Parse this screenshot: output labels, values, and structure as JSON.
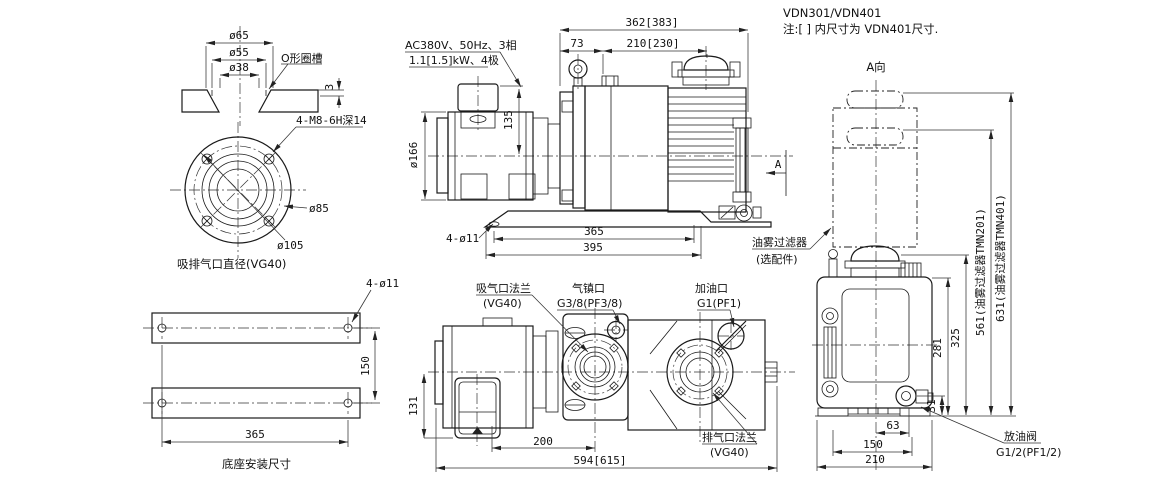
{
  "colors": {
    "line": "#1a1a1a",
    "background": "#ffffff"
  },
  "title": {
    "model": "VDN301/VDN401",
    "note": "注:[ ] 内尺寸为 VDN401尺寸."
  },
  "port_detail": {
    "d65": "ø65",
    "d55": "ø55",
    "d38": "ø38",
    "oring_label": "O形圈槽",
    "groove_depth": "3"
  },
  "flange_view": {
    "bolt_label": "4-M8-6H深14",
    "d85": "ø85",
    "d105": "ø105",
    "caption": "吸排气口直径(VG40)"
  },
  "base_view": {
    "hole_label": "4-ø11",
    "d150": "150",
    "d365": "365",
    "caption": "底座安装尺寸"
  },
  "side_view": {
    "motor_line1": "AC380V、50Hz、3相",
    "motor_line2": "1.1[1.5]kW、4极",
    "d_total": "362[383]",
    "d73": "73",
    "d210": "210[230]",
    "d135": "135",
    "d166": "ø166",
    "d365": "365",
    "d395": "395",
    "hole_label": "4-ø11",
    "view_arrow": "A",
    "filter_line1": "油雾过滤器",
    "filter_line2": "(选配件)"
  },
  "plan_view": {
    "suction_line1": "吸气口法兰",
    "suction_line2": "(VG40)",
    "ballast_line1": "气镇口",
    "ballast_line2": "G3/8(PF3/8)",
    "oil_line1": "加油口",
    "oil_line2": "G1(PF1)",
    "exhaust_line1": "排气口法兰",
    "exhaust_line2": "(VG40)",
    "d131": "131",
    "d200": "200",
    "d_total": "594[615]"
  },
  "a_view": {
    "title": "A向",
    "d631": "631(油雾过滤器TMN401)",
    "d561": "561(油雾过滤器TMN201)",
    "d325": "325",
    "d281": "281",
    "d31": "31",
    "d63": "63",
    "d150": "150",
    "d210": "210",
    "drain_line1": "放油阀",
    "drain_line2": "G1/2(PF1/2)"
  }
}
